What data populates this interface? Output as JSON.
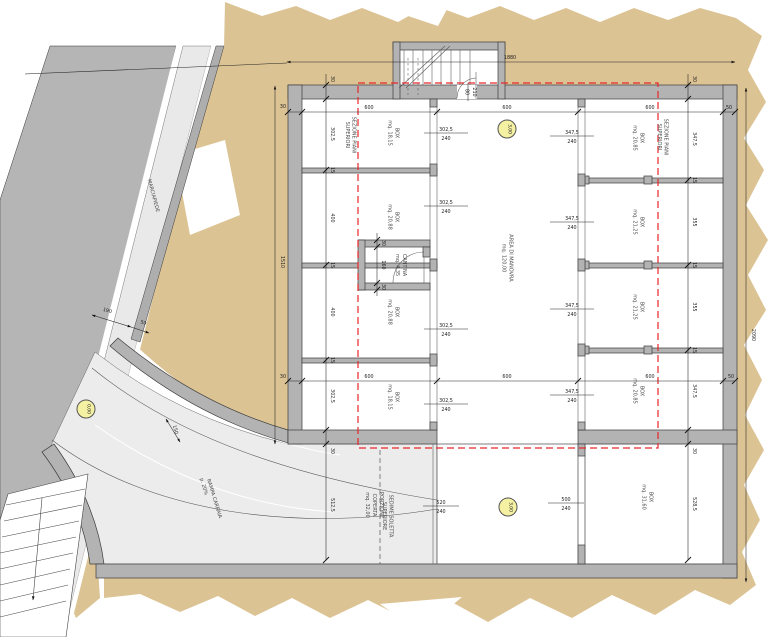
{
  "plan": {
    "labels": {
      "marciapiede": "MARCIAPIEDE",
      "rampa_line1": "RAMPA CARRAIA",
      "rampa_line2": "p. 20%",
      "sedime_line1": "SEDIME SOLETTA",
      "sedime_line2": "SUPERIORE",
      "sezione_line1": "SEZIONE PIANI",
      "sezione_line2": "SUPERIORI",
      "porzione_line1": "PORZIONE",
      "porzione_line2": "COPERTA",
      "porzione_area": "mq. 32,00"
    },
    "rooms": {
      "manovra_name": "AREA DI MANOVRA",
      "manovra_area": "mq. 120,00",
      "cantina_name": "CANTINA",
      "cantina_area": "mq. 4,35",
      "left_boxes": [
        {
          "name": "BOX",
          "area": "mq. 18,15"
        },
        {
          "name": "BOX",
          "area": "mq. 20,88"
        },
        {
          "name": "BOX",
          "area": "mq. 20,88"
        },
        {
          "name": "BOX",
          "area": "mq. 18,15"
        }
      ],
      "right_boxes": [
        {
          "name": "BOX",
          "area": "mq. 20,85"
        },
        {
          "name": "BOX",
          "area": "mq. 21,25"
        },
        {
          "name": "BOX",
          "area": "mq. 21,25"
        },
        {
          "name": "BOX",
          "area": "mq. 20,85"
        }
      ],
      "bottom_box_name": "BOX",
      "bottom_box_area": "mq. 31,60"
    },
    "levels": {
      "street": "0,00",
      "upper": "3,00",
      "lower": "3,00"
    },
    "doors": {
      "left_w": "302,5",
      "left_h": "240",
      "right_w": "347,5",
      "right_h": "240",
      "bottom_left_w": "520",
      "bottom_left_h": "240",
      "bottom_right_w": "500",
      "bottom_right_h": "240",
      "entry_w": "80",
      "entry_h": "210"
    },
    "dims": {
      "overall_top": "1880",
      "overall_right": "2090",
      "overall_left": "1510",
      "row": [
        "30",
        "600",
        "600",
        "600",
        "50"
      ],
      "left_chain": [
        "302,5",
        "15",
        "400",
        "15",
        "400",
        "15",
        "302,5"
      ],
      "right_chain": [
        "347,5",
        "15",
        "355",
        "15",
        "355",
        "15",
        "347,5"
      ],
      "wall_top": "30",
      "bottom_left": [
        "30",
        "512,5"
      ],
      "bottom_right": [
        "30",
        "528,5"
      ],
      "cantina": [
        "30",
        "160",
        "30"
      ],
      "sidewalk": [
        "190",
        "50",
        "150"
      ]
    },
    "colors": {
      "terrain": "#dcc394",
      "street": "#b5b5b5",
      "sidewalk": "#e9e9e9",
      "wall": "#b3b3b3",
      "red_dash": "#e8262a",
      "level_badge": "#f5f1a3"
    }
  }
}
